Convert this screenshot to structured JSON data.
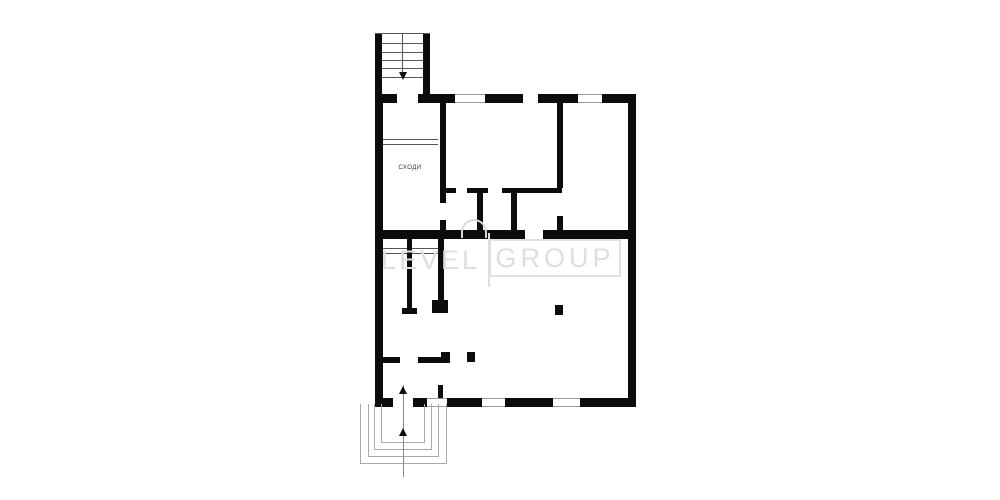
{
  "plan": {
    "stairs_room_label": "СХОДИ"
  },
  "watermark": {
    "level": "LEVEL",
    "group": "GROUP",
    "logo_icon": "arch-icon"
  },
  "colors": {
    "wall": "#0c0c0c",
    "window_line": "#999999",
    "porch_line": "#aaaaaa",
    "watermark": "#dedede",
    "background": "#ffffff"
  }
}
